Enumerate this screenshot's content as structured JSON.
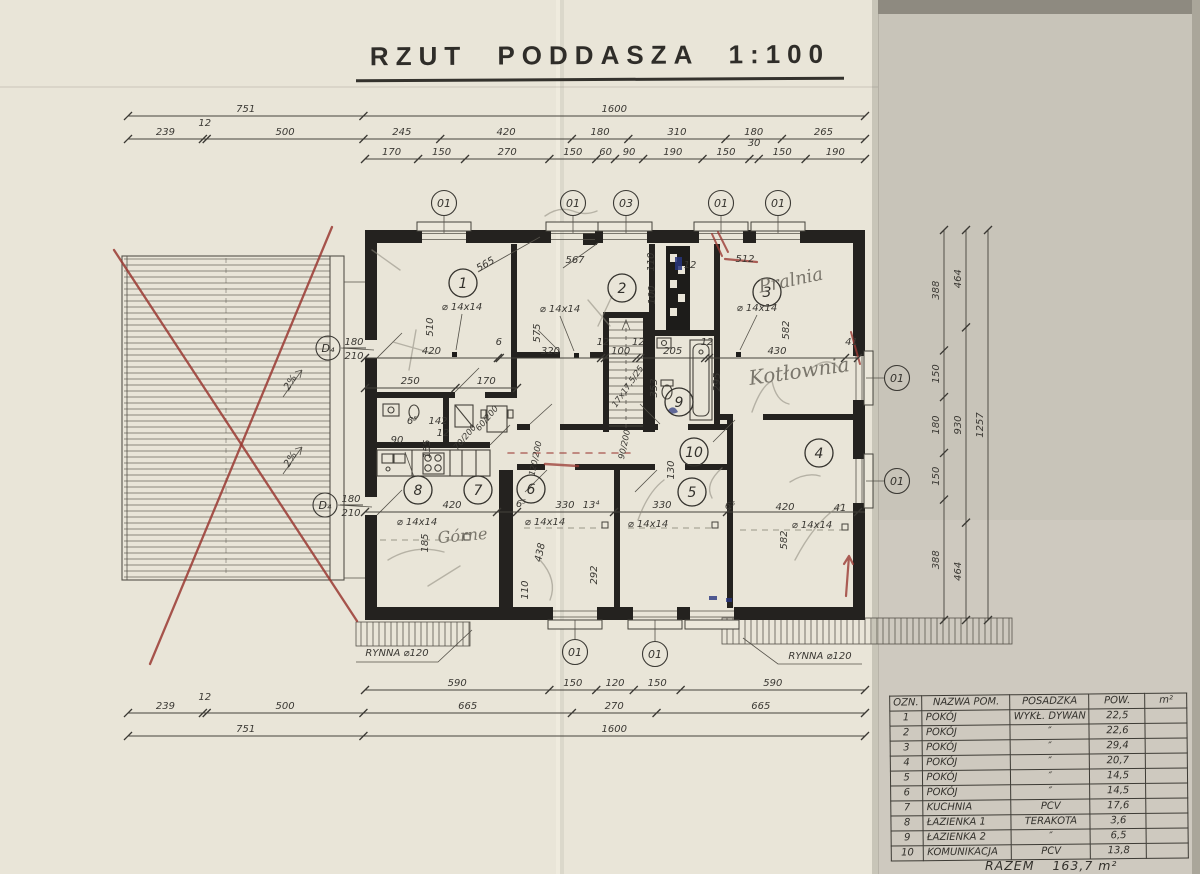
{
  "title": "RZUT PODDASZA 1:100",
  "colors": {
    "paper": "#e9e5d8",
    "paper_right": "#c8c4b9",
    "ink": "#35332e",
    "wall": "#24221f",
    "red": "#9a3a33",
    "blue": "#27357f",
    "pencil": "#8c887c"
  },
  "dim_chains": [
    {
      "dir": "h",
      "pos": 116,
      "from": 128,
      "to": 865,
      "segs": [
        "751",
        "1600"
      ]
    },
    {
      "dir": "h",
      "pos": 139,
      "from": 128,
      "to": 865,
      "segs": [
        "239",
        "12",
        "500",
        "245",
        "420",
        "180",
        "310",
        "180",
        "265"
      ]
    },
    {
      "dir": "h",
      "pos": 159,
      "from": 365,
      "to": 865,
      "segs": [
        "170",
        "150",
        "270",
        "150",
        "60",
        "90",
        "190",
        "150",
        "30",
        "150",
        "190"
      ]
    },
    {
      "dir": "h",
      "pos": 358,
      "from": 365,
      "to": 858,
      "segs": [
        "420",
        "6",
        "320",
        "12",
        "100",
        "12",
        "205",
        "12",
        "430",
        "41"
      ]
    },
    {
      "dir": "h",
      "pos": 388,
      "from": 365,
      "to": 517,
      "segs": [
        "250",
        "170"
      ]
    },
    {
      "dir": "h",
      "pos": 690,
      "from": 365,
      "to": 865,
      "segs": [
        "590",
        "150",
        "120",
        "150",
        "590"
      ]
    },
    {
      "dir": "h",
      "pos": 713,
      "from": 128,
      "to": 865,
      "segs": [
        "239",
        "12",
        "500",
        "665",
        "270",
        "665"
      ]
    },
    {
      "dir": "h",
      "pos": 736,
      "from": 128,
      "to": 865,
      "segs": [
        "751",
        "1600"
      ]
    },
    {
      "dir": "v",
      "pos": 944,
      "from": 230,
      "to": 620,
      "segs": [
        "388",
        "150",
        "180",
        "150",
        "388"
      ]
    },
    {
      "dir": "v",
      "pos": 966,
      "from": 230,
      "to": 620,
      "segs": [
        "464",
        "930",
        "464"
      ]
    },
    {
      "dir": "v",
      "pos": 988,
      "from": 230,
      "to": 620,
      "segs": [
        "1257"
      ]
    }
  ],
  "texts": [
    {
      "t": "510",
      "x": 433,
      "y": 327,
      "r": -90
    },
    {
      "t": "575",
      "x": 540,
      "y": 333,
      "r": -90
    },
    {
      "t": "565",
      "x": 487,
      "y": 267,
      "r": -30
    },
    {
      "t": "567",
      "x": 575,
      "y": 263
    },
    {
      "t": "110",
      "x": 654,
      "y": 262,
      "r": -90
    },
    {
      "t": "12",
      "x": 690,
      "y": 268
    },
    {
      "t": "512",
      "x": 745,
      "y": 262
    },
    {
      "t": "582",
      "x": 789,
      "y": 330,
      "r": -90
    },
    {
      "t": "100",
      "x": 655,
      "y": 295,
      "r": -90
    },
    {
      "t": "353",
      "x": 657,
      "y": 388,
      "r": -90
    },
    {
      "t": "295",
      "x": 720,
      "y": 382,
      "r": -90
    },
    {
      "t": "⌀ 14x14",
      "x": 462,
      "y": 310
    },
    {
      "t": "⌀ 14x14",
      "x": 560,
      "y": 312
    },
    {
      "t": "⌀ 14x14",
      "x": 757,
      "y": 311
    },
    {
      "t": "6⁵",
      "x": 412,
      "y": 424
    },
    {
      "t": "142",
      "x": 438,
      "y": 424
    },
    {
      "t": "90",
      "x": 397,
      "y": 443
    },
    {
      "t": "12",
      "x": 443,
      "y": 436
    },
    {
      "t": "155",
      "x": 430,
      "y": 449,
      "r": -90
    },
    {
      "t": "70/200",
      "x": 467,
      "y": 439,
      "r": -50,
      "s": 8.5
    },
    {
      "t": "60/200",
      "x": 489,
      "y": 420,
      "r": -50,
      "s": 8.5
    },
    {
      "t": "120/200",
      "x": 538,
      "y": 459,
      "r": -78,
      "s": 8.5
    },
    {
      "t": "90/200",
      "x": 627,
      "y": 445,
      "r": -78,
      "s": 8.5
    },
    {
      "t": "130",
      "x": 674,
      "y": 470,
      "r": -90
    },
    {
      "t": "420",
      "x": 452,
      "y": 508
    },
    {
      "t": "6⁵",
      "x": 521,
      "y": 507
    },
    {
      "t": "330",
      "x": 565,
      "y": 508
    },
    {
      "t": "13⁴",
      "x": 591,
      "y": 508
    },
    {
      "t": "330",
      "x": 662,
      "y": 508
    },
    {
      "t": "6⁵",
      "x": 730,
      "y": 509
    },
    {
      "t": "420",
      "x": 785,
      "y": 510
    },
    {
      "t": "41",
      "x": 840,
      "y": 511
    },
    {
      "t": "⌀ 14x14",
      "x": 417,
      "y": 525
    },
    {
      "t": "⌀ 14x14",
      "x": 545,
      "y": 525
    },
    {
      "t": "⌀ 14x14",
      "x": 648,
      "y": 527
    },
    {
      "t": "⌀ 14x14",
      "x": 812,
      "y": 528
    },
    {
      "t": "185",
      "x": 428,
      "y": 543,
      "r": -90
    },
    {
      "t": "438",
      "x": 543,
      "y": 553,
      "r": -78
    },
    {
      "t": "110",
      "x": 528,
      "y": 590,
      "r": -90
    },
    {
      "t": "292",
      "x": 597,
      "y": 575,
      "r": -90
    },
    {
      "t": "582",
      "x": 787,
      "y": 540,
      "r": -90
    },
    {
      "t": "2%",
      "x": 293,
      "y": 384,
      "r": -58
    },
    {
      "t": "2%",
      "x": 293,
      "y": 461,
      "r": -58
    },
    {
      "t": "17x17,5/25",
      "x": 630,
      "y": 388,
      "r": -55,
      "s": 8.5
    },
    {
      "t": "RYNNA ⌀120",
      "x": 397,
      "y": 656
    },
    {
      "t": "RYNNA ⌀120",
      "x": 820,
      "y": 659
    }
  ],
  "window_tags": [
    {
      "t": "01",
      "x": 444,
      "y": 203
    },
    {
      "t": "01",
      "x": 573,
      "y": 203
    },
    {
      "t": "03",
      "x": 626,
      "y": 203
    },
    {
      "t": "01",
      "x": 721,
      "y": 203
    },
    {
      "t": "01",
      "x": 778,
      "y": 203
    },
    {
      "t": "01",
      "x": 897,
      "y": 378
    },
    {
      "t": "01",
      "x": 897,
      "y": 481
    },
    {
      "t": "01",
      "x": 575,
      "y": 652
    },
    {
      "t": "01",
      "x": 655,
      "y": 654
    }
  ],
  "room_tags": [
    {
      "n": "1",
      "x": 463,
      "y": 283
    },
    {
      "n": "2",
      "x": 622,
      "y": 288
    },
    {
      "n": "3",
      "x": 767,
      "y": 292
    },
    {
      "n": "4",
      "x": 819,
      "y": 453
    },
    {
      "n": "5",
      "x": 692,
      "y": 492
    },
    {
      "n": "6",
      "x": 531,
      "y": 489
    },
    {
      "n": "7",
      "x": 478,
      "y": 490
    },
    {
      "n": "8",
      "x": 418,
      "y": 490
    },
    {
      "n": "9",
      "x": 679,
      "y": 402
    },
    {
      "n": "10",
      "x": 694,
      "y": 452
    }
  ],
  "door_tags": [
    {
      "label": "D₄",
      "num": "180",
      "den": "210",
      "x": 328,
      "y": 348
    },
    {
      "label": "D₄",
      "num": "180",
      "den": "210",
      "x": 325,
      "y": 505
    }
  ],
  "handwritten": [
    {
      "t": "Pralnia",
      "x": 792,
      "y": 286,
      "r": -12,
      "s": 18
    },
    {
      "t": "Kotłownia",
      "x": 800,
      "y": 378,
      "r": -8,
      "s": 20
    },
    {
      "t": "Górne",
      "x": 463,
      "y": 541,
      "r": -5,
      "s": 16
    }
  ],
  "table": {
    "headers": [
      "OZN.",
      "NAZWA POM.",
      "POSADZKA",
      "POW.",
      "m²"
    ],
    "rows": [
      [
        "1",
        "POKÓJ",
        "WYKŁ. DYWAN",
        "22,5",
        ""
      ],
      [
        "2",
        "POKÓJ",
        "″",
        "22,6",
        ""
      ],
      [
        "3",
        "POKÓJ",
        "″",
        "29,4",
        ""
      ],
      [
        "4",
        "POKÓJ",
        "″",
        "20,7",
        ""
      ],
      [
        "5",
        "POKÓJ",
        "″",
        "14,5",
        ""
      ],
      [
        "6",
        "POKÓJ",
        "″",
        "14,5",
        ""
      ],
      [
        "7",
        "KUCHNIA",
        "PCV",
        "17,6",
        ""
      ],
      [
        "8",
        "ŁAZIENKA 1",
        "TERAKOTA",
        "3,6",
        ""
      ],
      [
        "9",
        "ŁAZIENKA 2",
        "″",
        "6,5",
        ""
      ],
      [
        "10",
        "KOMUNIKACJA",
        "PCV",
        "13,8",
        ""
      ]
    ],
    "total": {
      "label": "RAZEM",
      "value": "163,7 m²"
    }
  }
}
